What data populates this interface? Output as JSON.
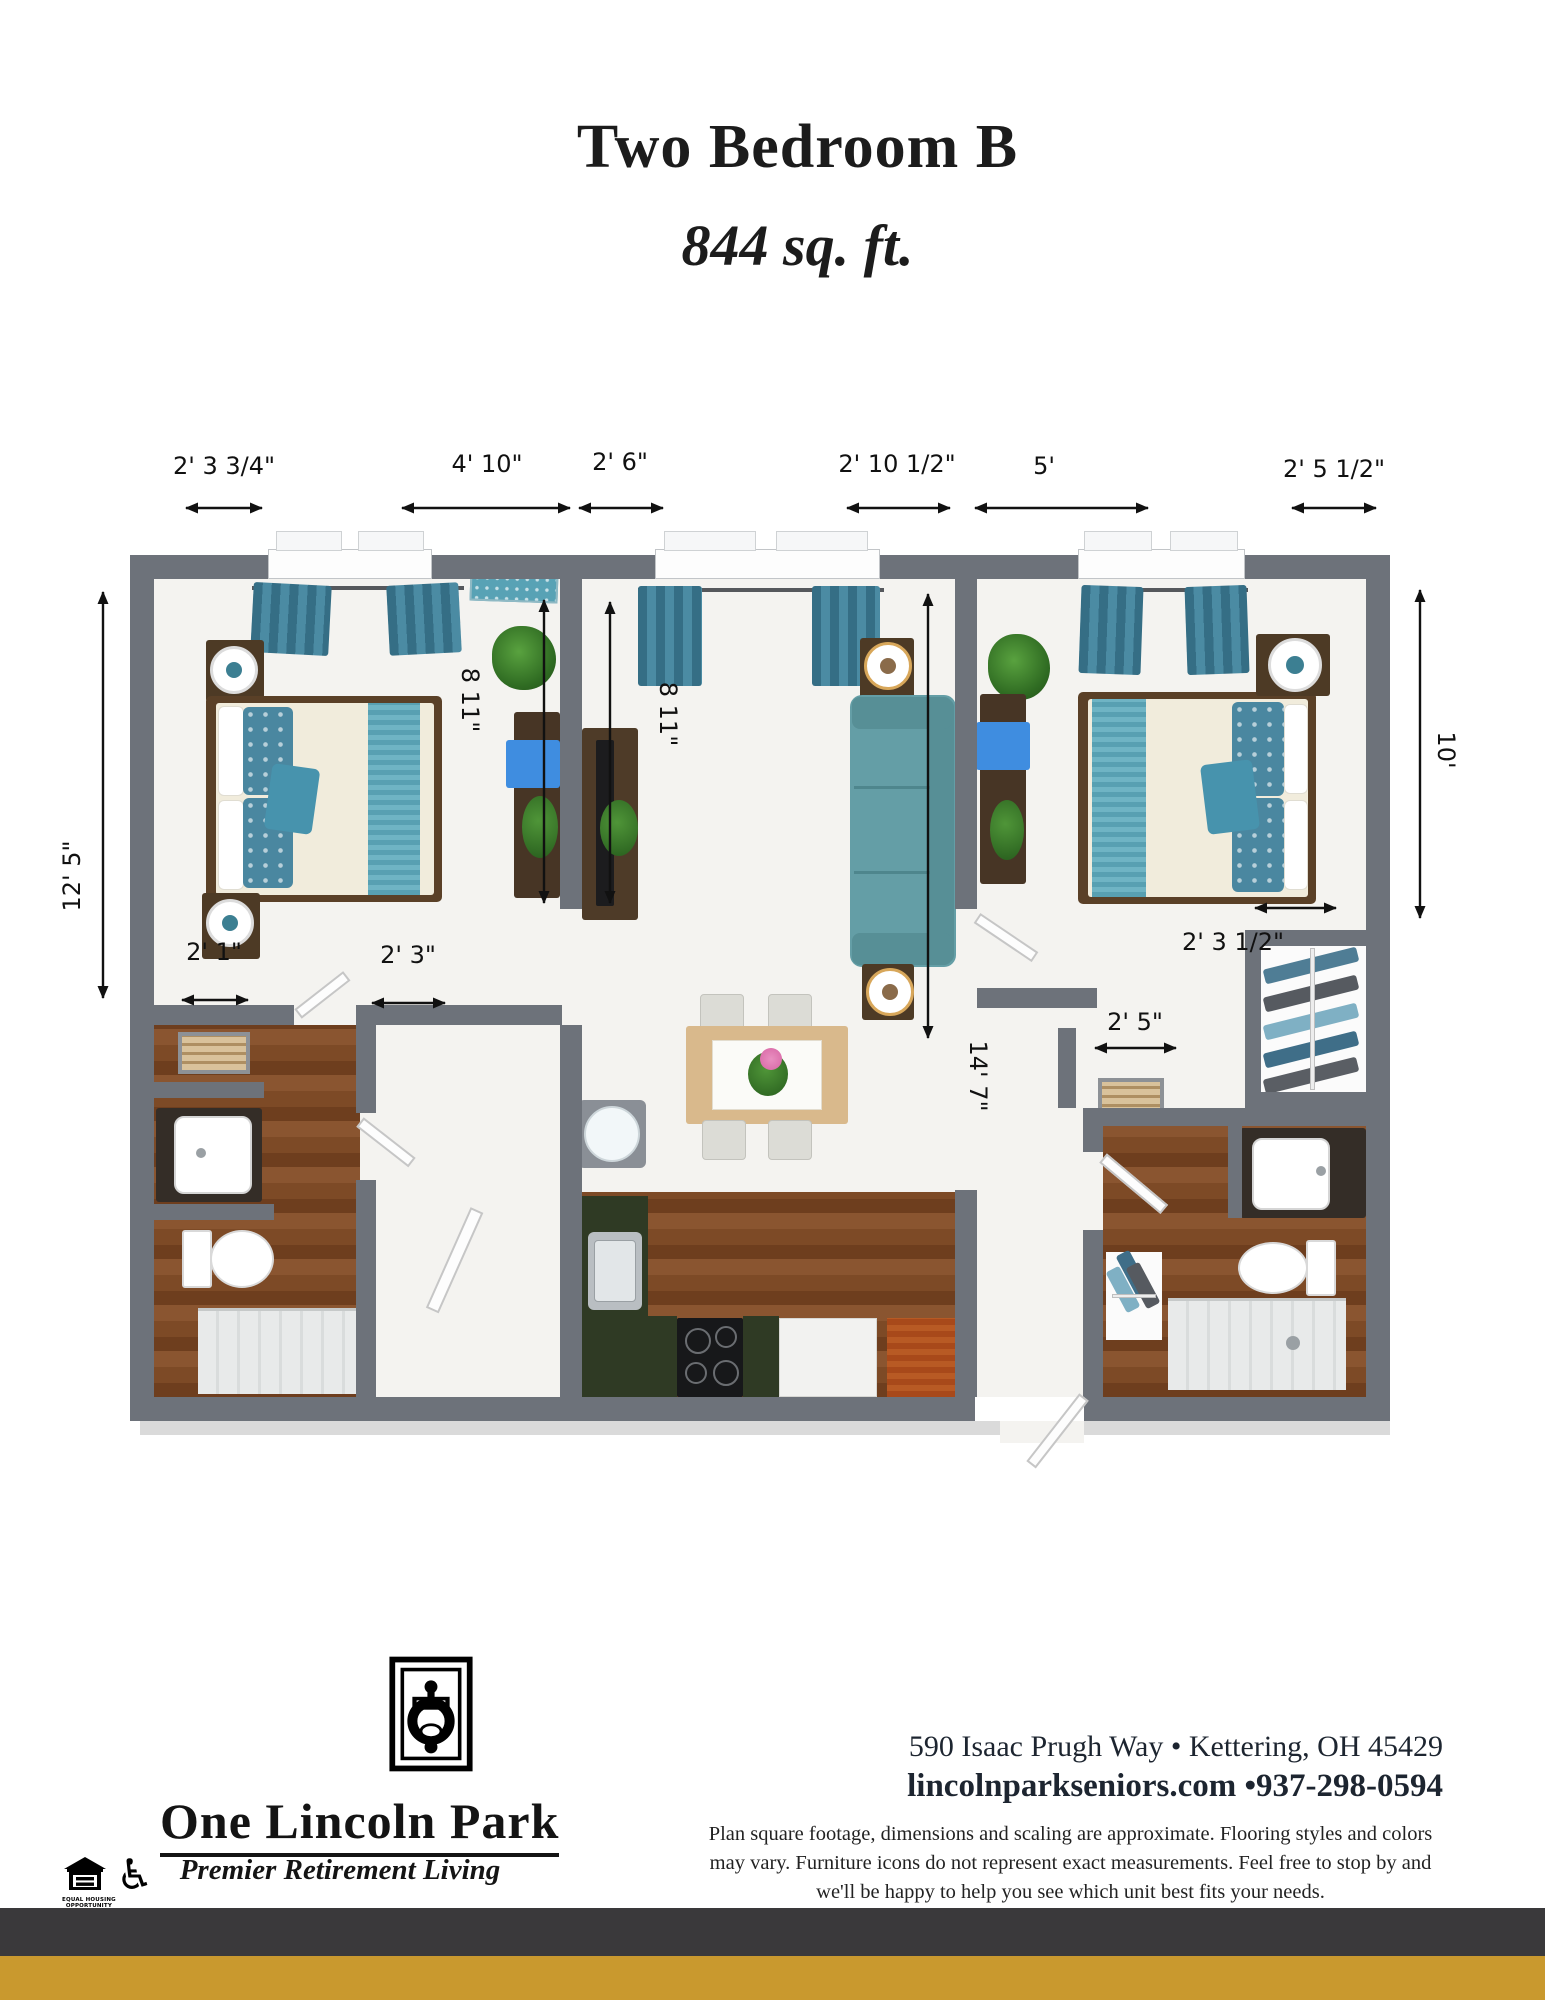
{
  "header": {
    "title": "Two Bedroom B",
    "subtitle": "844 sq. ft."
  },
  "plan": {
    "dims_top": [
      "2' 3  3/4\"",
      "4' 10\"",
      "2' 6\"",
      "2' 10 1/2\"",
      "5'",
      "2' 5 1/2\""
    ],
    "dim_left": "12' 5\"",
    "dim_right": "10'",
    "dim_bed1_depth": "8 11\"",
    "dim_living_depth": "8 11\"",
    "dim_living_length": "14' 7\"",
    "dim_bath1_door": "2' 1\"",
    "dim_hall_door": "2' 3\"",
    "dim_closet": "2' 3 1/2\"",
    "dim_bath2_door": "2' 5\""
  },
  "footer": {
    "brand_name": "One Lincoln Park",
    "brand_tagline": "Premier Retirement Living",
    "address": "590 Isaac Prugh Way • Kettering, OH 45429",
    "contact": "lincolnparkseniors.com •937-298-0594",
    "disclaimer": "Plan square footage, dimensions and scaling are approximate. Flooring styles and colors may vary. Furniture icons do not represent exact measurements. Feel free to stop by and we'll be happy to help you see which unit best fits your needs.",
    "equal_housing_line1": "EQUAL HOUSING",
    "equal_housing_line2": "OPPORTUNITY",
    "accessibility_icon": "♿"
  },
  "colors": {
    "wall": "#6d727a",
    "teal": "#4b8ba3",
    "bar_dark": "#3a393b",
    "accent_gold": "#c9992e"
  }
}
